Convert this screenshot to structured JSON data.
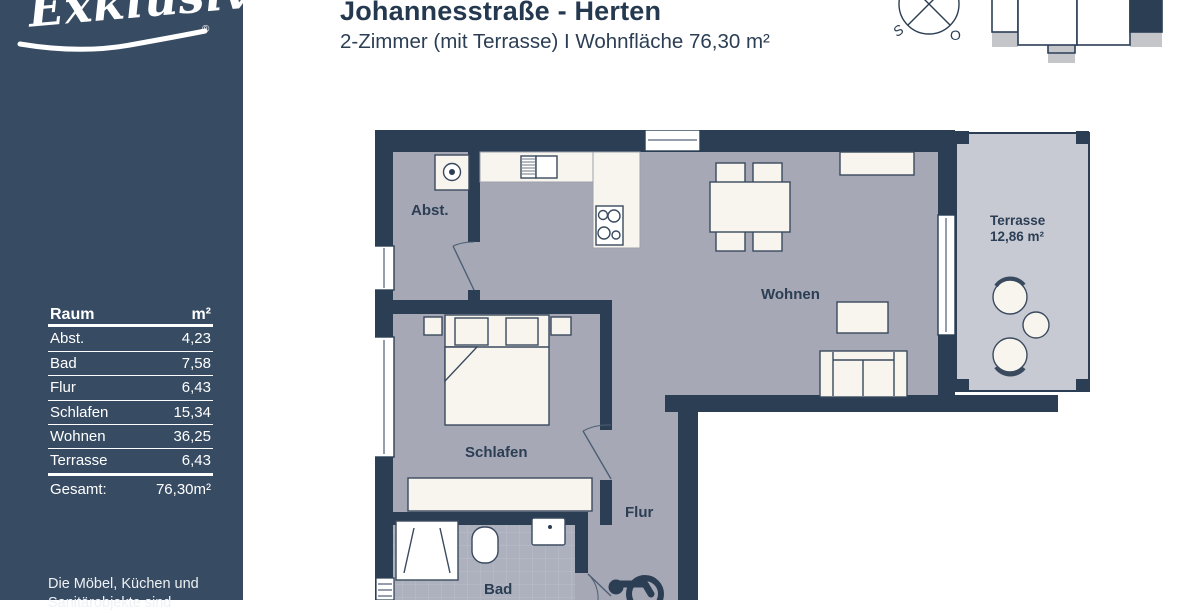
{
  "brand": {
    "logo_text": "Exklusiv",
    "registered": "®"
  },
  "header": {
    "title": "Johannesstraße - Herten",
    "subtitle": "2-Zimmer (mit Terrasse) I Wohnfläche 76,30 m²"
  },
  "compass": {
    "south": "S",
    "east": "O"
  },
  "sidebar": {
    "table": {
      "col_room": "Raum",
      "col_area": "m²",
      "rows": [
        {
          "room": "Abst.",
          "area": "4,23"
        },
        {
          "room": "Bad",
          "area": "7,58"
        },
        {
          "room": "Flur",
          "area": "6,43"
        },
        {
          "room": "Schlafen",
          "area": "15,34"
        },
        {
          "room": "Wohnen",
          "area": "36,25"
        },
        {
          "room": "Terrasse",
          "area": "6,43"
        }
      ],
      "total_label": "Gesamt:",
      "total_value": "76,30m²"
    },
    "disclaimer_line1": "Die Möbel, Küchen und",
    "disclaimer_line2": "Sanitärobjekte sind"
  },
  "plan": {
    "rooms": {
      "abst": "Abst.",
      "schlafen": "Schlafen",
      "bad": "Bad",
      "flur": "Flur",
      "wohnen": "Wohnen",
      "terrasse": "Terrasse",
      "terrasse_area": "12,86 m²"
    }
  },
  "colors": {
    "sidebar_bg": "#374b63",
    "wall": "#2b3e54",
    "floor": "#a6a8b5",
    "bath_floor": "#adb0bd",
    "terrace_floor": "#c8cad3",
    "furniture": "#f8f5ee",
    "balcony_gray": "#c5c6ca",
    "title_text": "#24394f"
  }
}
